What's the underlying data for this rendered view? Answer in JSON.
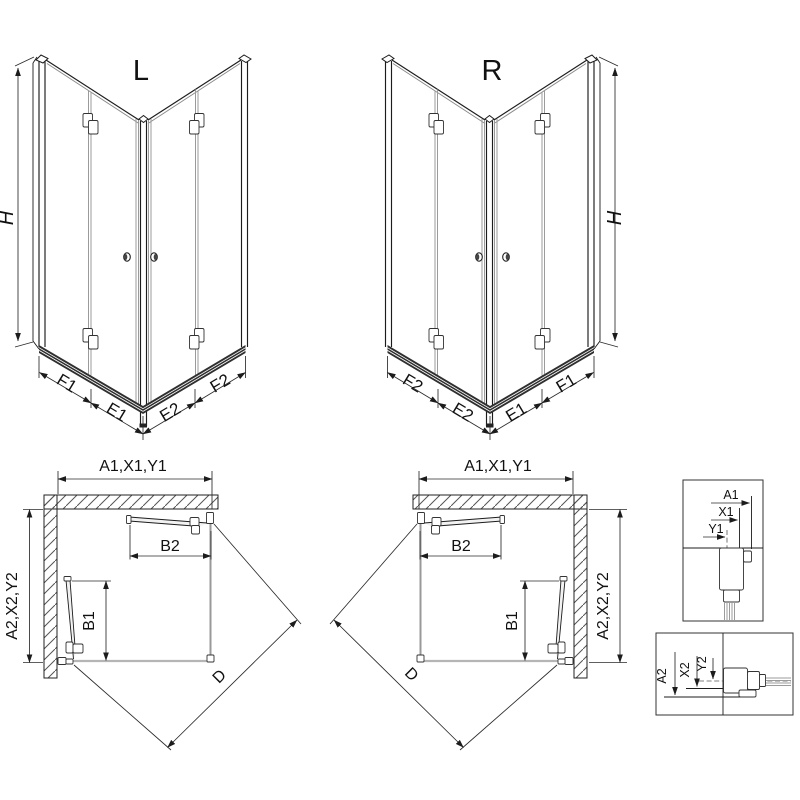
{
  "drawing": {
    "left_view": {
      "label": "L",
      "height": "H",
      "widths": [
        "F1",
        "E1",
        "E2",
        "F2"
      ]
    },
    "right_view": {
      "label": "R",
      "height": "H",
      "widths": [
        "F2",
        "E2",
        "E1",
        "F1"
      ]
    },
    "left_plan": {
      "top_dim": "A1,X1,Y1",
      "side_dim": "A2,X2,Y2",
      "door_top": "B2",
      "door_side": "B1",
      "diagonal": "D"
    },
    "right_plan": {
      "top_dim": "A1,X1,Y1",
      "side_dim": "A2,X2,Y2",
      "door_top": "B2",
      "door_side": "B1",
      "diagonal": "D"
    },
    "detail_top": {
      "dims": [
        "A1",
        "X1",
        "Y1"
      ]
    },
    "detail_bottom": {
      "dims": [
        "A2",
        "X2",
        "Y2"
      ]
    }
  },
  "colors": {
    "line": "#1c1c1c",
    "glass": "#9b9b9b",
    "rail": "#2f2f2f",
    "hatch": "#555555",
    "background": "#ffffff"
  }
}
